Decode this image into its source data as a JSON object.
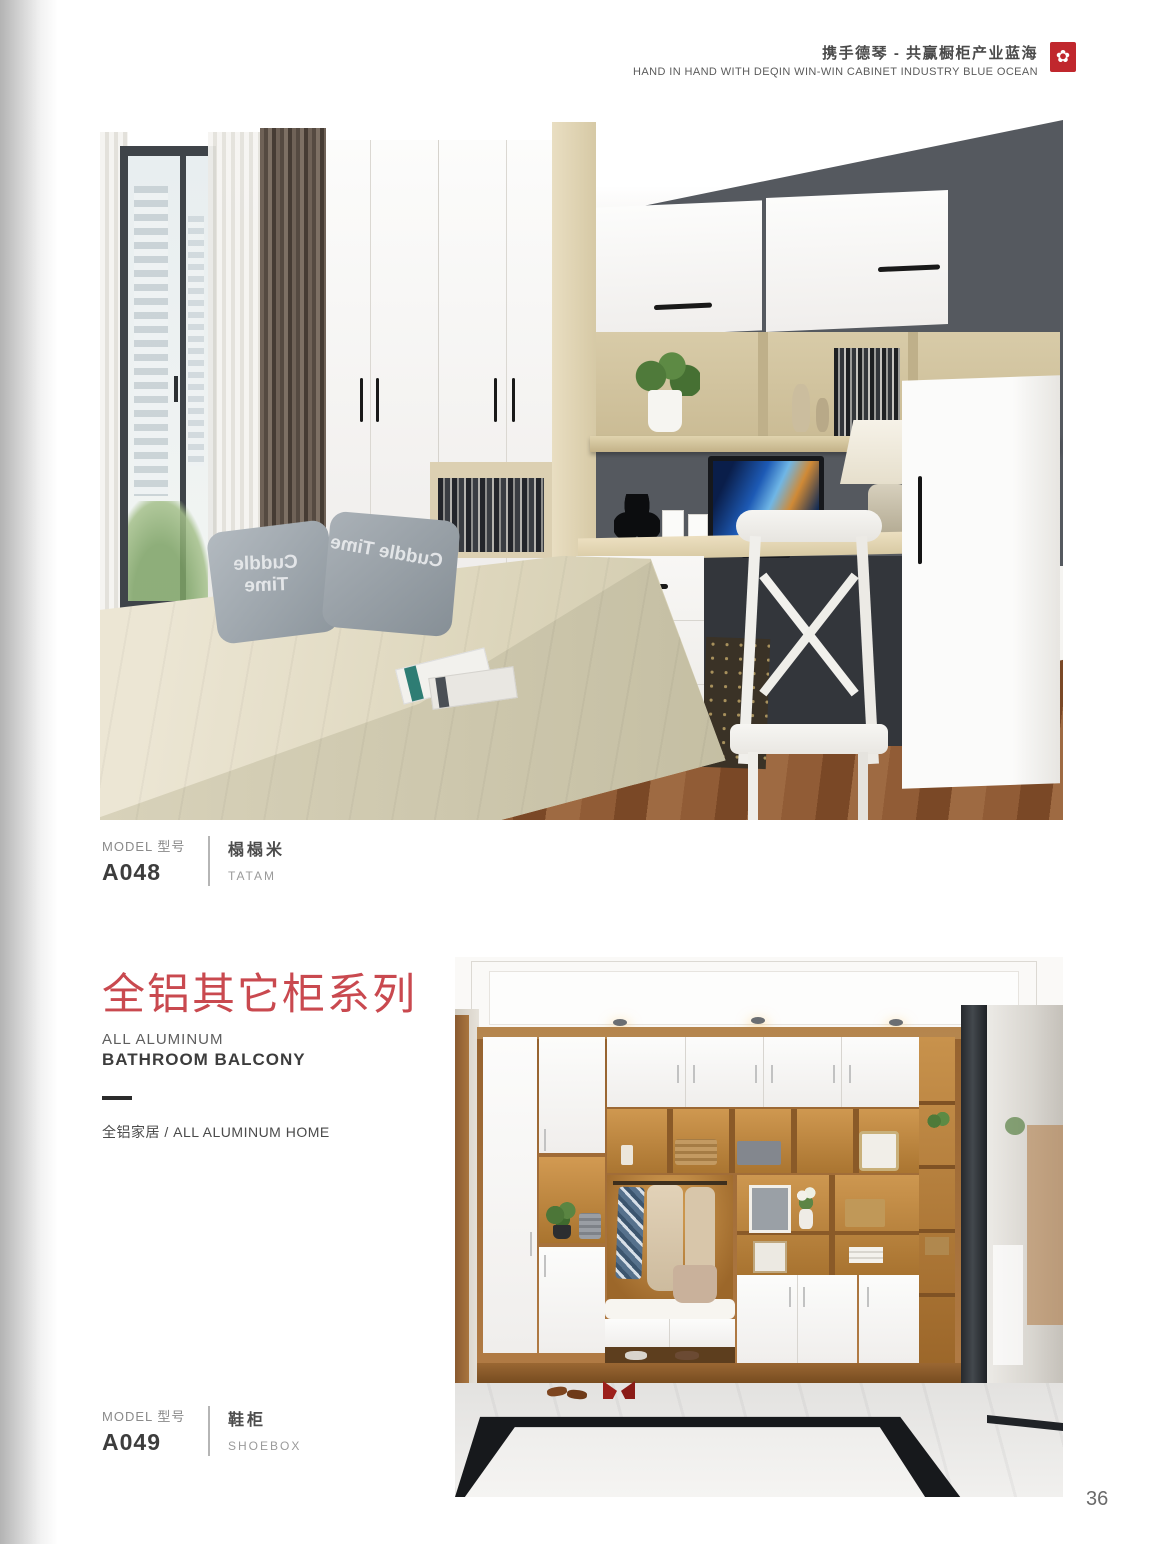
{
  "header": {
    "tagline_zh": "携手德琴 - 共赢橱柜产业蓝海",
    "tagline_en": "HAND IN HAND WITH DEQIN WIN-WIN CABINET INDUSTRY BLUE OCEAN",
    "logo_glyph": "✿"
  },
  "section": {
    "title_zh": "全铝其它柜系列",
    "subtitle_en_1": "ALL ALUMINUM",
    "subtitle_en_2": "BATHROOM BALCONY",
    "family_line": "全铝家居 / ALL ALUMINUM HOME"
  },
  "products": [
    {
      "model_label": "MODEL 型号",
      "code": "A048",
      "name_zh": "榻榻米",
      "name_en": "TATAM"
    },
    {
      "model_label": "MODEL 型号",
      "code": "A049",
      "name_zh": "鞋柜",
      "name_en": "SHOEBOX"
    }
  ],
  "photos": {
    "pillow_text": "Cuddle Time"
  },
  "page_number": "36",
  "colors": {
    "accent_red": "#c9494f",
    "logo_red": "#c0272d"
  }
}
